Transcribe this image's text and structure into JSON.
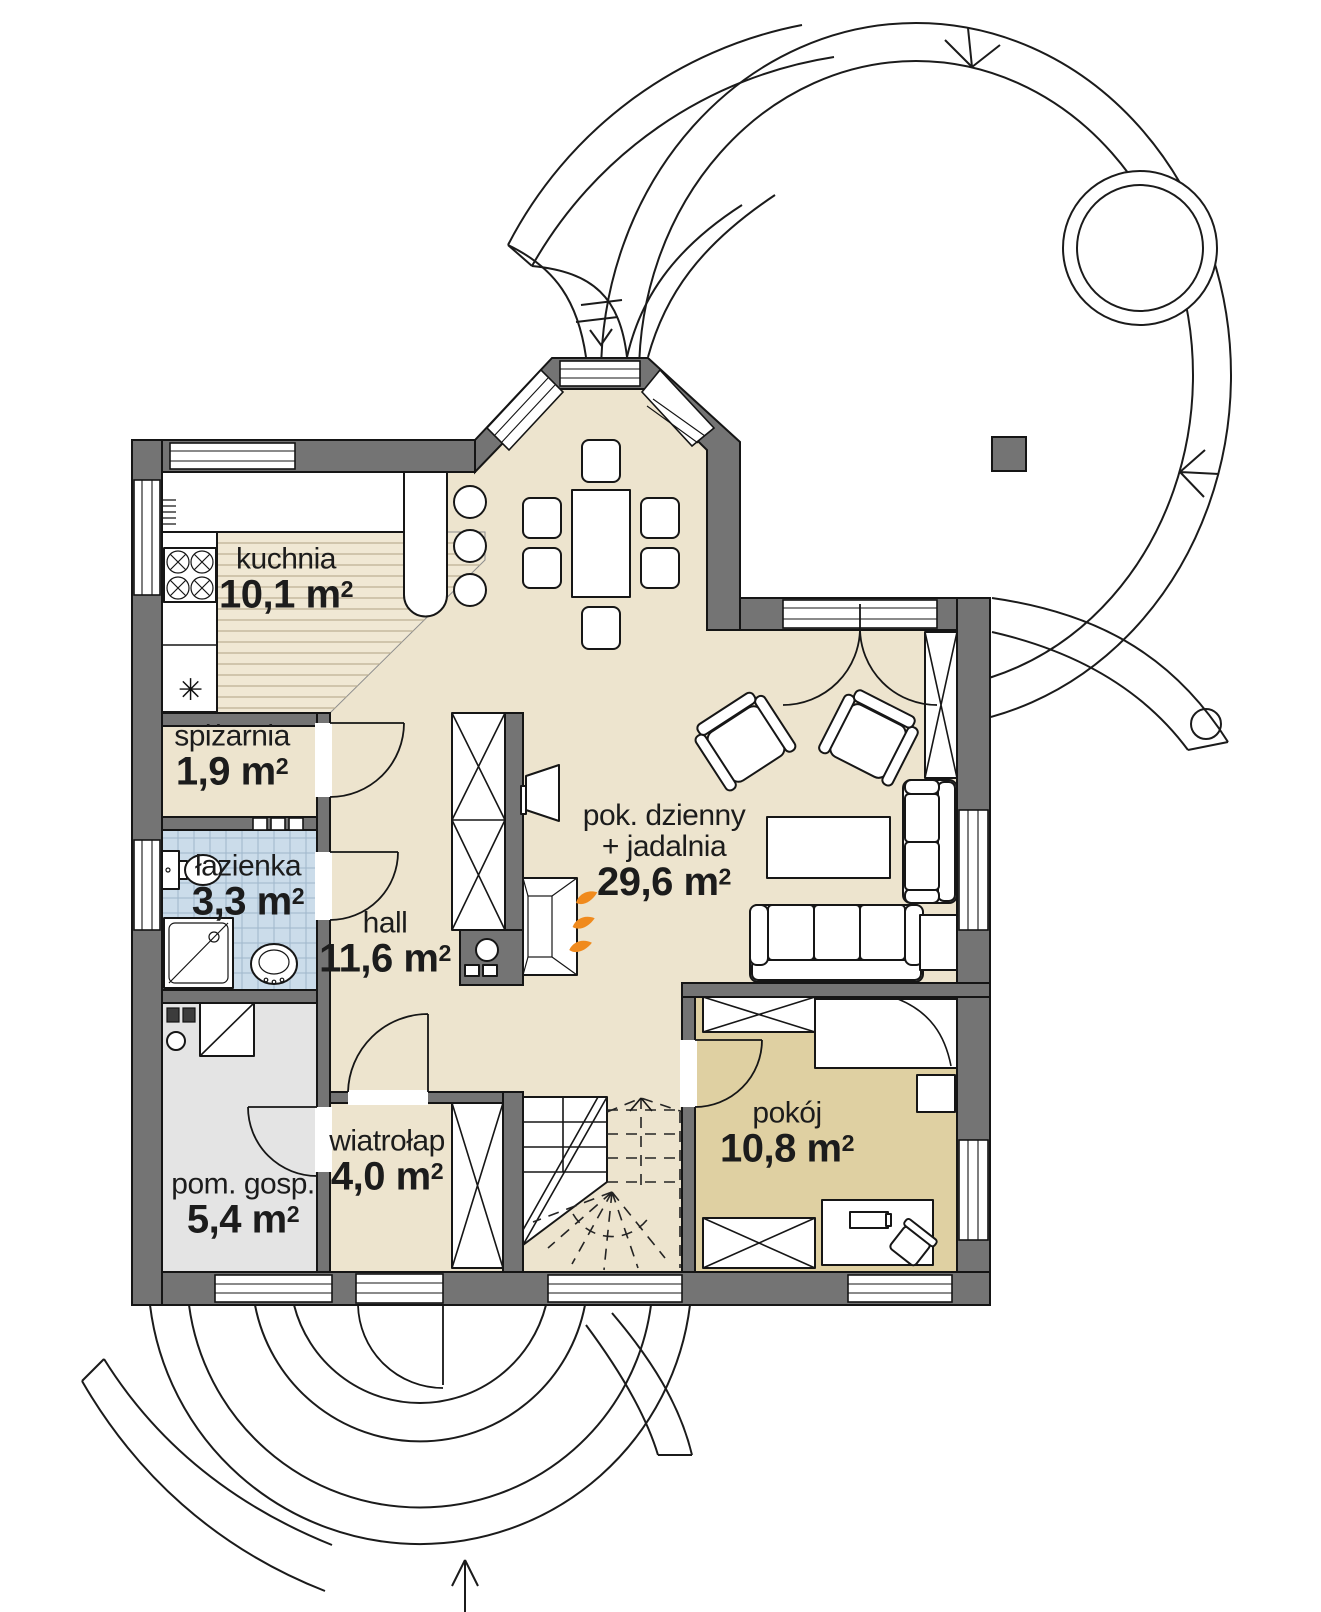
{
  "page": {
    "background": "#ffffff",
    "kind": "floor-plan"
  },
  "colors": {
    "page_bg": "#ffffff",
    "wall": "#747474",
    "floor_main": "#EDE4CE",
    "floor_room": "#DFD0A2",
    "floor_bath": "#CBDCEA",
    "floor_utility": "#E4E4E4",
    "floor_wood": "#F0E8D4",
    "wood_line": "#BCB094",
    "tile_line": "#9FB6CB",
    "flame": "#F08A1D"
  },
  "rooms": [
    {
      "id": "kuchnia",
      "name": "kuchnia",
      "area": "10,1 m",
      "sup": "2"
    },
    {
      "id": "spizarnia",
      "name": "spiżarnia",
      "area": "1,9 m",
      "sup": "2"
    },
    {
      "id": "lazienka",
      "name": "łazienka",
      "area": "3,3 m",
      "sup": "2"
    },
    {
      "id": "hall",
      "name": "hall",
      "area": "11,6 m",
      "sup": "2"
    },
    {
      "id": "pom-gosp",
      "name": "pom. gosp.",
      "area": "5,4 m",
      "sup": "2"
    },
    {
      "id": "wiatrolap",
      "name": "wiatrołap",
      "area": "4,0 m",
      "sup": "2"
    },
    {
      "id": "pok-dzienny",
      "name": "pok. dzienny",
      "name2": "+ jadalnia",
      "area": "29,6 m",
      "sup": "2"
    },
    {
      "id": "pokoj",
      "name": "pokój",
      "area": "10,8 m",
      "sup": "2"
    }
  ],
  "icons": {
    "fridge_glyph": "✳"
  }
}
